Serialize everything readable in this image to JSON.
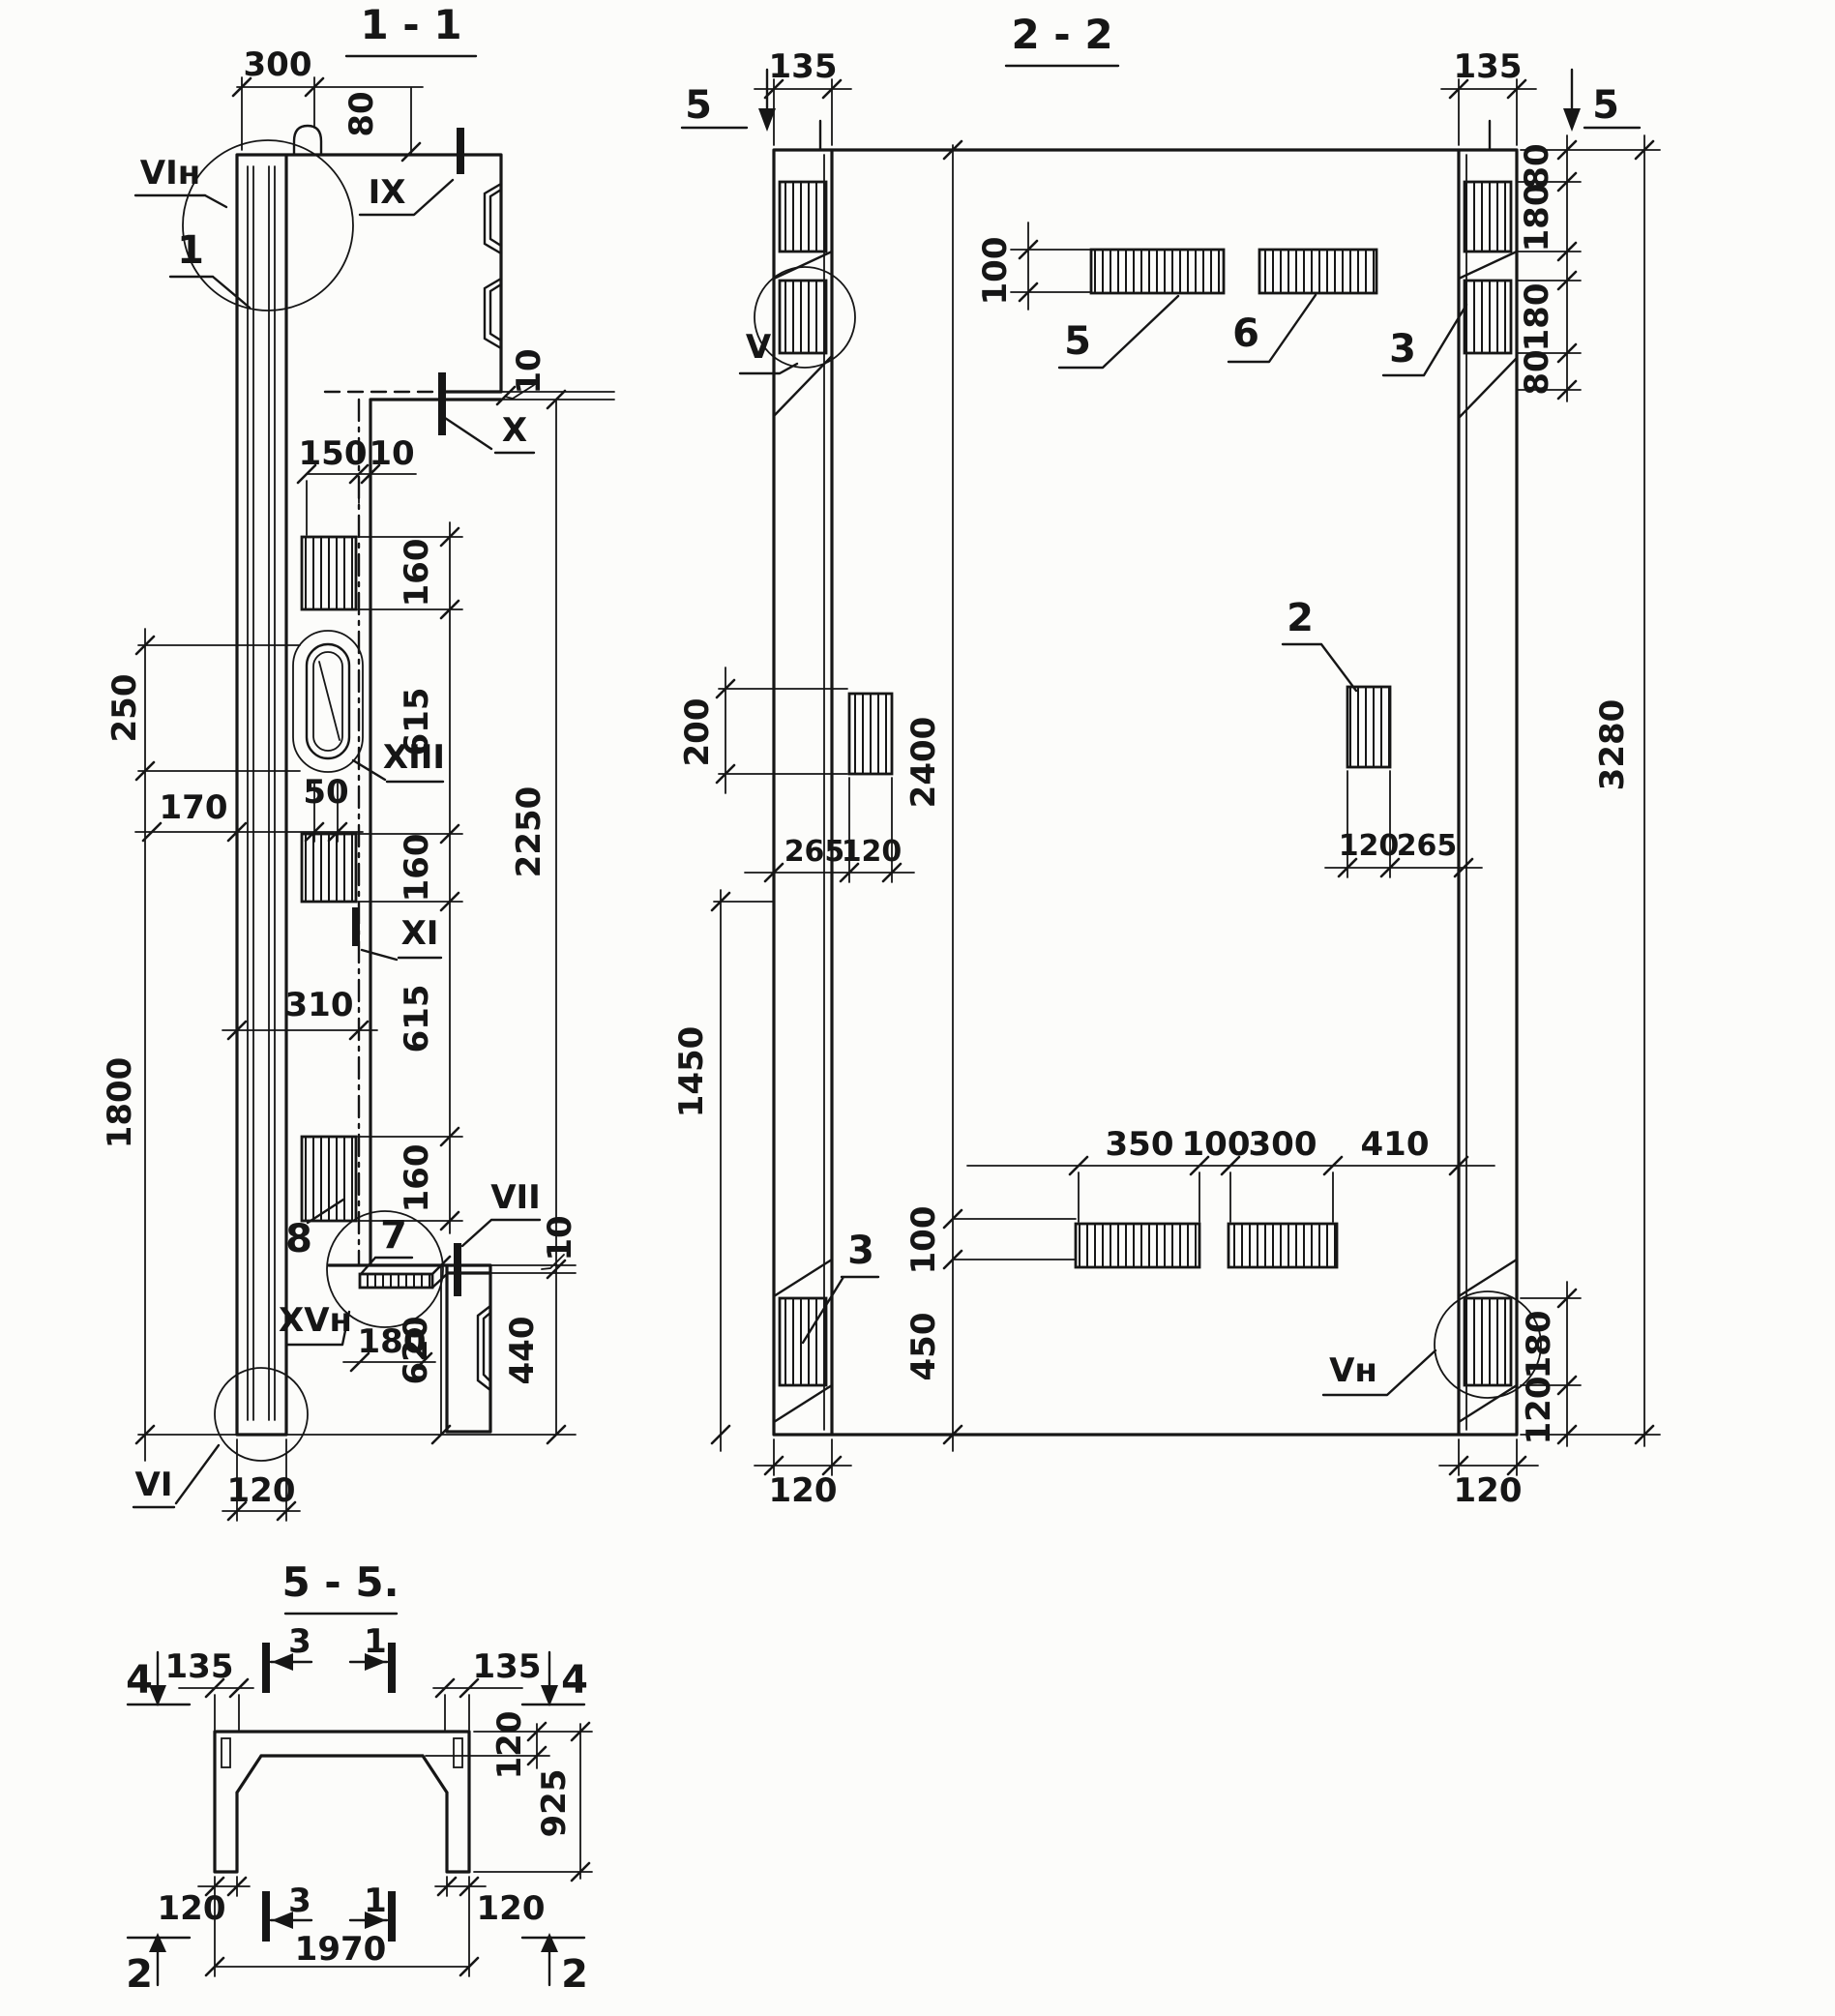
{
  "drawing": {
    "s11": {
      "title": "1 - 1",
      "d300": "300",
      "d80": "80",
      "d10a": "10",
      "d150": "150",
      "d10b": "10",
      "d160": "160",
      "d615": "615",
      "d50": "50",
      "d170": "170",
      "d250": "250",
      "d310": "310",
      "d1800": "1800",
      "d2250": "2250",
      "d180": "180",
      "d620": "620",
      "d440": "440",
      "d10c": "10",
      "d120": "120",
      "lVIn": "VIн",
      "lIX": "IX",
      "lX": "X",
      "lXI": "XI",
      "lXIII": "XIII",
      "lVII": "VII",
      "lXVn": "XVн",
      "lVI": "VI",
      "n1": "1",
      "n7": "7",
      "n8": "8"
    },
    "s22": {
      "title": "2 - 2",
      "cut5": "5",
      "d135": "135",
      "d80": "80",
      "d180": "180",
      "d3280": "3280",
      "d100": "100",
      "d200": "200",
      "d2400": "2400",
      "d265": "265",
      "d120": "120",
      "d1450": "1450",
      "d350": "350",
      "d300": "300",
      "d410": "410",
      "d450": "450",
      "n5": "5",
      "n6": "6",
      "n3": "3",
      "n2": "2",
      "lV": "V",
      "lVn": "Vн"
    },
    "s55": {
      "title": "5 - 5.",
      "cut4": "4",
      "cut2": "2",
      "c3": "3",
      "c1": "1",
      "d135": "135",
      "d120": "120",
      "d925": "925",
      "d1970": "1970"
    }
  }
}
